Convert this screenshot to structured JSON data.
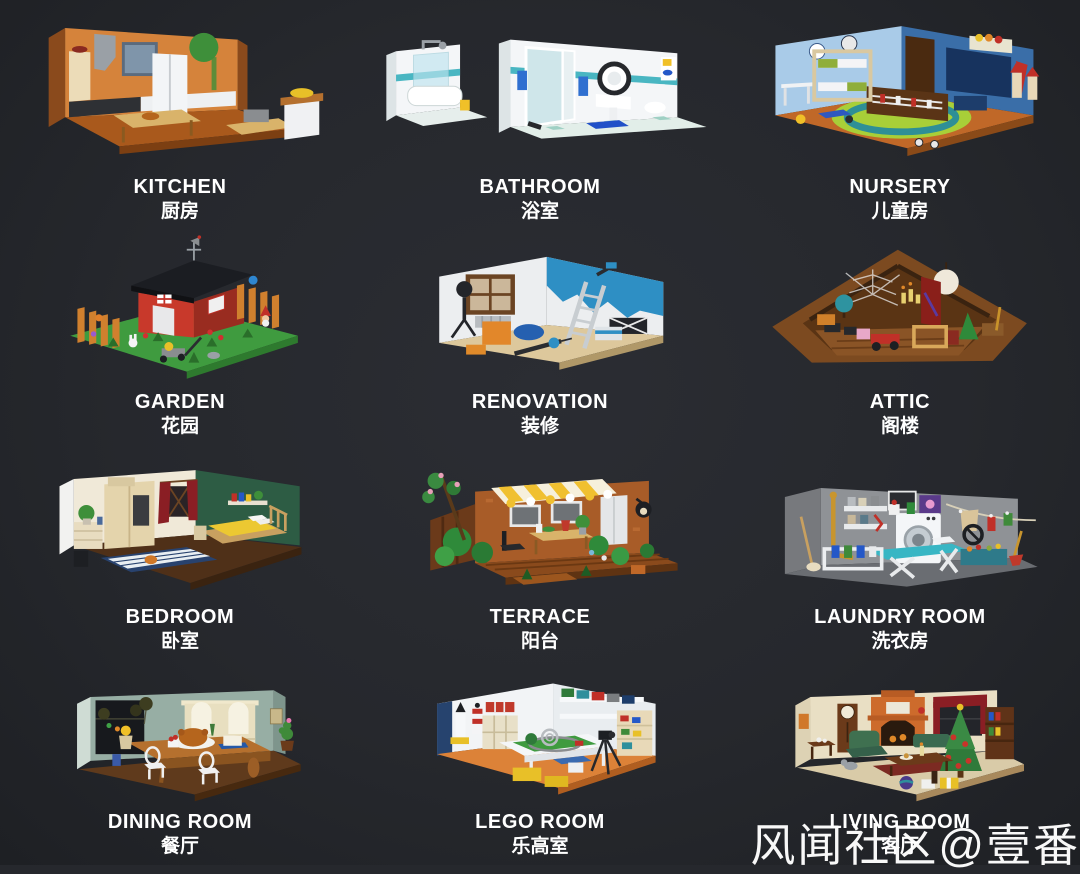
{
  "page": {
    "background": "#26282d",
    "text_color": "#ffffff",
    "layout": "grid of 12 LEGO room dioramas, 3 columns x 4 rows, each with English and Chinese caption"
  },
  "watermark": {
    "text": "风闻社区@壹番",
    "color": "#ffffff"
  },
  "rooms": [
    {
      "id": "kitchen",
      "name_en": "KITCHEN",
      "name_zh": "厨房",
      "colors": {
        "wall": "#d5833b",
        "floor": "#aa5a1d",
        "accent": "#f3f5f7"
      }
    },
    {
      "id": "bathroom",
      "name_en": "BATHROOM",
      "name_zh": "浴室",
      "colors": {
        "wall": "#f4f6f8",
        "floor": "#e2eee9",
        "accent": "#49b6c2"
      }
    },
    {
      "id": "nursery",
      "name_en": "NURSERY",
      "name_zh": "儿童房",
      "colors": {
        "wall": "#a9cbe8",
        "wall2": "#3a6ea8",
        "floor": "#c06828",
        "accent": "#a8cf38"
      }
    },
    {
      "id": "garden",
      "name_en": "GARDEN",
      "name_zh": "花园",
      "colors": {
        "base": "#3f9b3f",
        "shed": "#c8392b",
        "roof": "#1b1d22",
        "fence": "#d0802e"
      }
    },
    {
      "id": "renovation",
      "name_en": "RENOVATION",
      "name_zh": "装修",
      "colors": {
        "wall": "#eceef0",
        "paint": "#2e8fc4",
        "floor": "#ddc89c"
      }
    },
    {
      "id": "attic",
      "name_en": "ATTIC",
      "name_zh": "阁楼",
      "colors": {
        "frame": "#7c4a20",
        "wall": "#5a3414",
        "floor": "#8a5426"
      }
    },
    {
      "id": "bedroom",
      "name_en": "BEDROOM",
      "name_zh": "卧室",
      "colors": {
        "wall": "#f0e9d8",
        "wall2": "#2d5c44",
        "floor": "#4f3018",
        "blanket": "#ecc832"
      }
    },
    {
      "id": "terrace",
      "name_en": "TERRACE",
      "name_zh": "阳台",
      "colors": {
        "wall": "#a85c28",
        "deck": "#8a4a1c",
        "awning": "#f0c030",
        "foliage": "#2f8a3a"
      }
    },
    {
      "id": "laundry",
      "name_en": "LAUNDRY ROOM",
      "name_zh": "洗衣房",
      "colors": {
        "wall": "#8f9296",
        "floor": "#6a6d72",
        "accent": "#38b6c4"
      }
    },
    {
      "id": "dining",
      "name_en": "DINING ROOM",
      "name_zh": "餐厅",
      "colors": {
        "wall": "#97aea4",
        "floor": "#5f3a1c",
        "table": "#b5702e"
      }
    },
    {
      "id": "lego",
      "name_en": "LEGO ROOM",
      "name_zh": "乐高室",
      "colors": {
        "wall": "#f2f4f6",
        "floor": "#dc8238"
      }
    },
    {
      "id": "living",
      "name_en": "LIVING ROOM",
      "name_zh": "客厅",
      "colors": {
        "wall": "#e9dfc4",
        "floor": "#d9cba8",
        "tree": "#2f7a3a"
      }
    }
  ]
}
